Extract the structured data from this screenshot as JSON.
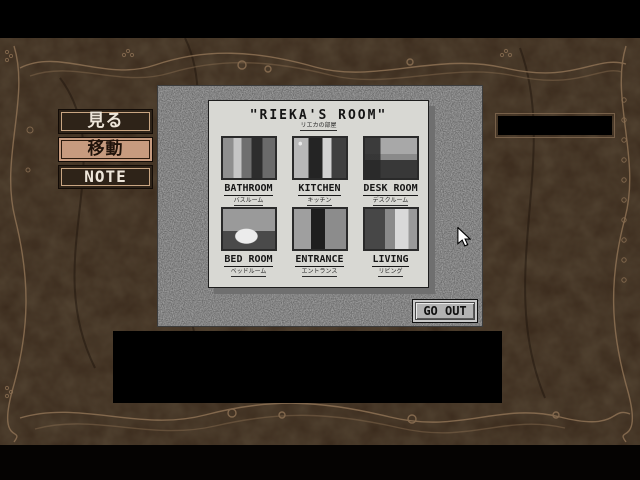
{
  "left_menu": {
    "items": [
      {
        "label": "見る",
        "selected": false
      },
      {
        "label": "移動",
        "selected": true
      },
      {
        "label": "NOTE",
        "selected": false
      }
    ]
  },
  "room_map": {
    "title": "\"RIEKA'S ROOM\"",
    "title_ruby": "リエカの部屋",
    "rooms": [
      {
        "label": "BATHROOM",
        "ruby": "バスルーム"
      },
      {
        "label": "KITCHEN",
        "ruby": "キッチン"
      },
      {
        "label": "DESK ROOM",
        "ruby": "デスクルーム"
      },
      {
        "label": "BED ROOM",
        "ruby": "ベッドルーム"
      },
      {
        "label": "ENTRANCE",
        "ruby": "エントランス"
      },
      {
        "label": "LIVING",
        "ruby": "リビング"
      }
    ],
    "go_out_label": "GO OUT"
  },
  "message_areas": {
    "top_right": "",
    "bottom": ""
  },
  "colors": {
    "background_wood": "#3a2a1c",
    "ornament": "#8d7154",
    "panel_gray": "#a9a9a9",
    "card": "#d8d8d3",
    "selected_button": "#c79b7f",
    "button_dark": "#2e2318"
  },
  "cursor": "arrow"
}
